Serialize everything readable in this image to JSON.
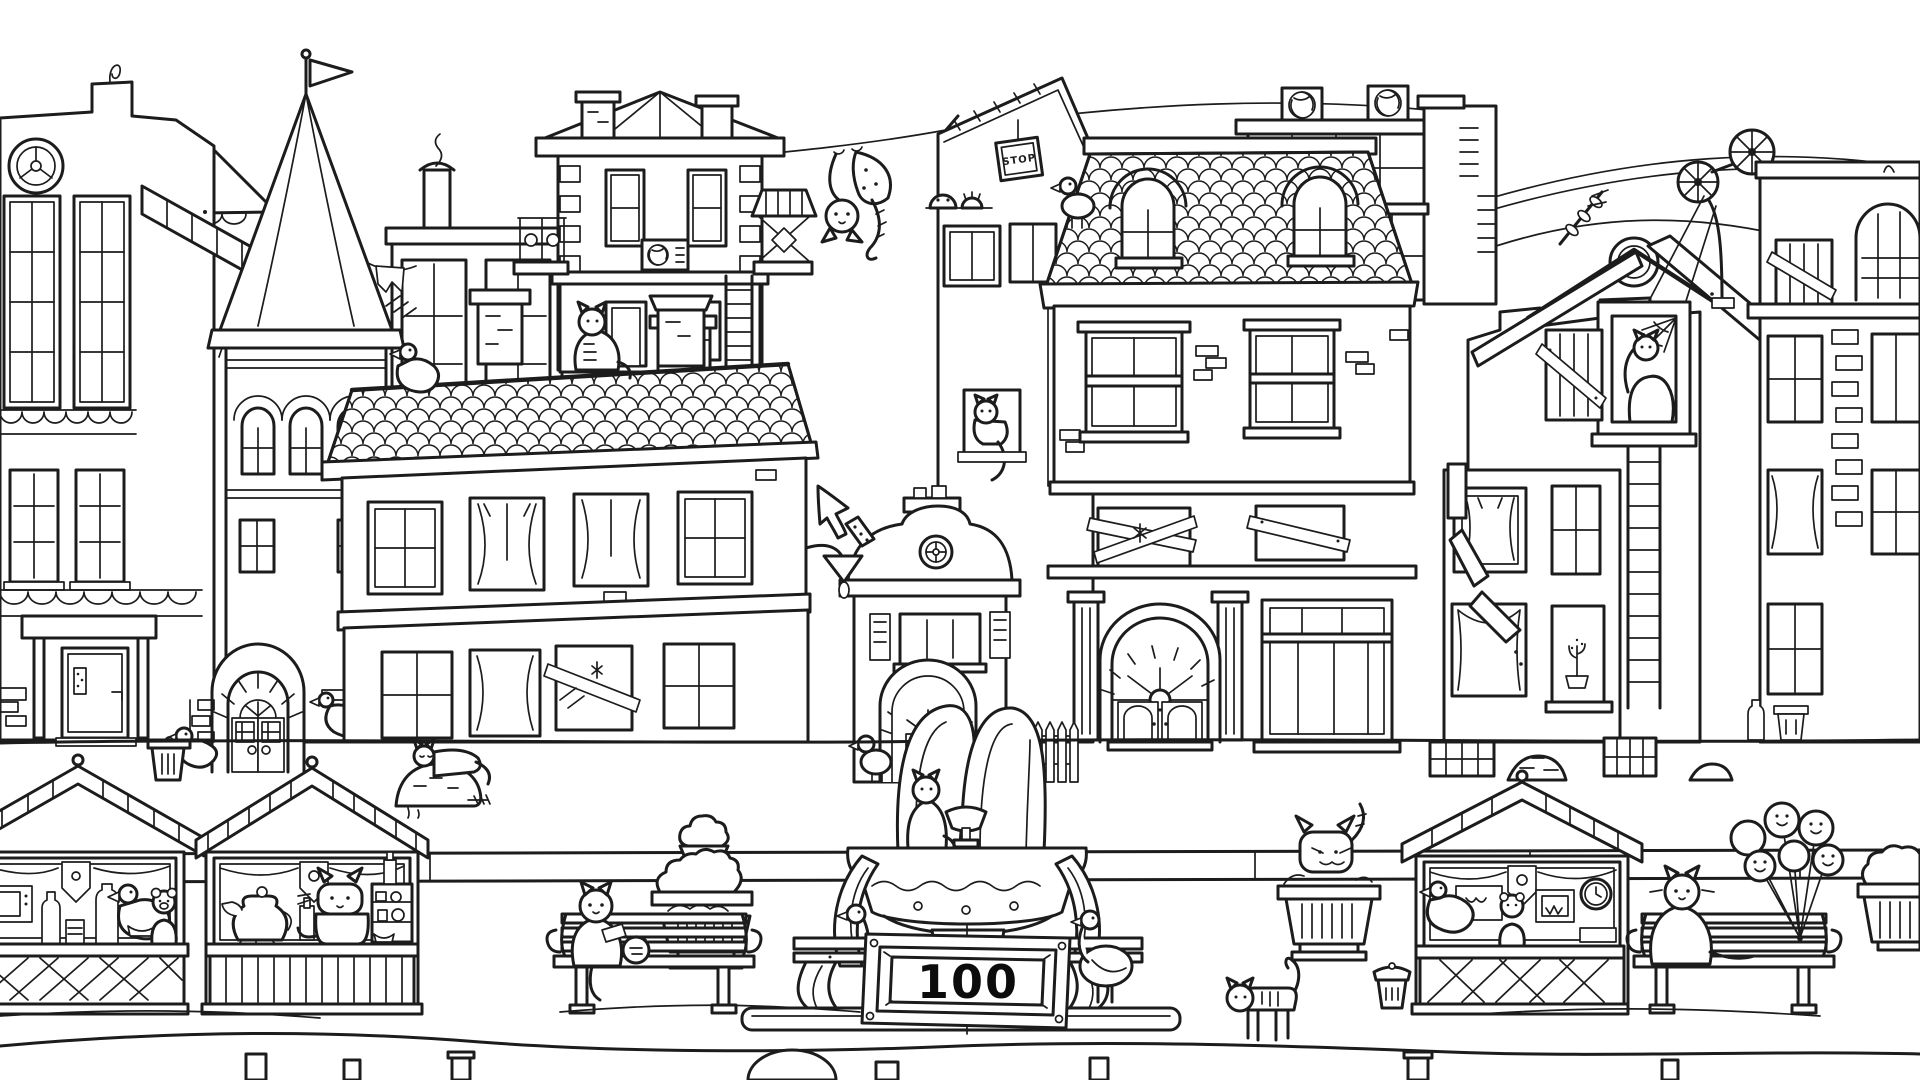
{
  "hud": {
    "counter": "100"
  },
  "posters": {
    "stop_sign": "STOP"
  },
  "palette": {
    "ink": "#1c1c1c",
    "paper": "#ffffff"
  },
  "scene": {
    "kind": "hand-drawn black-and-white hidden-object town square",
    "cats": [
      "cat-on-left-roof-ridge",
      "cat-hanging-from-clothesline",
      "cat-in-upper-window",
      "cat-in-ruined-window",
      "cat-on-fountain-rim",
      "cat-on-stall-counter",
      "cat-on-left-bench",
      "cat-on-planter",
      "cat-on-right-bench",
      "cat-walking-by-trash-can",
      "cat-on-garbage-pile"
    ],
    "birds": [
      "duck-on-left-roof",
      "pigeon-on-downspout",
      "goose-on-pipe",
      "pigeon-on-mansard-roof",
      "pigeon-by-chapel-door",
      "pigeon-behind-fountain-sign",
      "pigeon-beside-fountain-sign",
      "pigeon-on-left-stall-counter",
      "pigeon-on-right-stall-counter"
    ],
    "props": [
      "market-stall",
      "park-bench",
      "topiary-planter",
      "ornate-fountain",
      "score-sign",
      "balloon-bunch",
      "trash-can",
      "stop-poster",
      "weather-vane",
      "ladder",
      "picket-fence",
      "clothesline",
      "boarded-window",
      "spider-web",
      "garbage-pile"
    ]
  }
}
